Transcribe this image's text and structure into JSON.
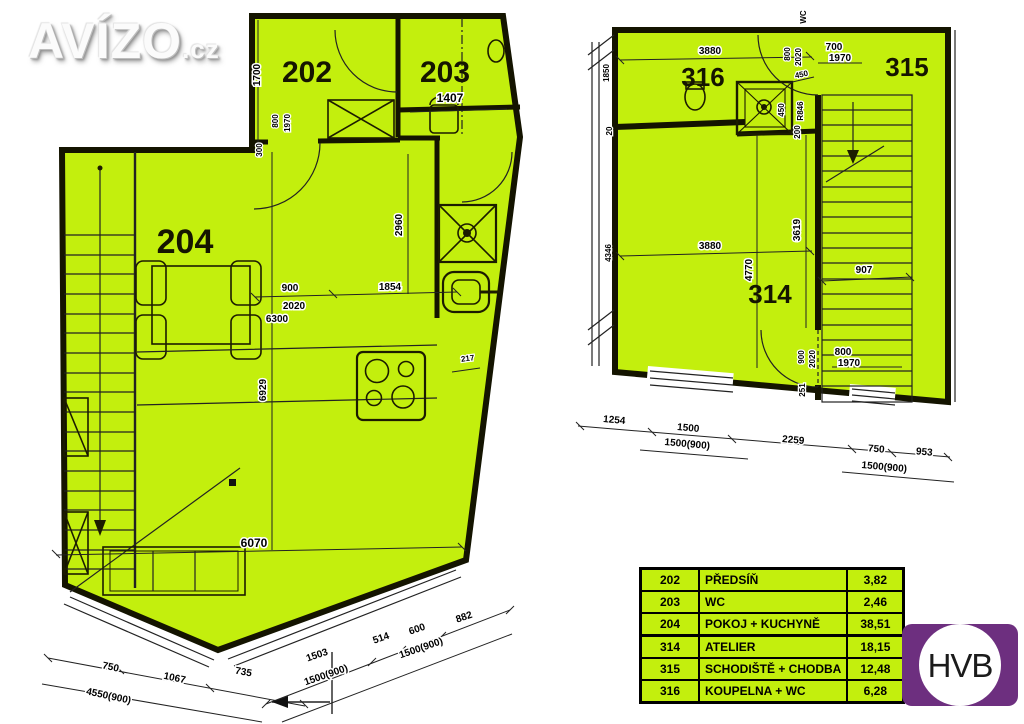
{
  "branding": {
    "logo_text": "AVÍZO",
    "logo_tld": ".cz"
  },
  "hvb": {
    "label": "HVB",
    "purple": "#6d2f7f"
  },
  "colors": {
    "plan_green": "#c3ef0d",
    "wall_black": "#141400"
  },
  "left_plan": {
    "room_labels": {
      "r202": "202",
      "r203": "203",
      "r204": "204"
    },
    "dims": {
      "w1700": "1700",
      "w800": "800",
      "w1970": "1970",
      "w300": "300",
      "w1407": "1407",
      "w2960": "2960",
      "w900": "900",
      "w2020": "2020",
      "w6300": "6300",
      "w1854": "1854",
      "w217": "217",
      "w6929": "6929",
      "w6070": "6070",
      "w750": "750",
      "w1067": "1067",
      "w735": "735",
      "w4550_900": "4550(900)",
      "w1503": "1503",
      "w1500_900a": "1500(900)",
      "w514": "514",
      "w600": "600",
      "w1500_900b": "1500(900)",
      "w882": "882"
    }
  },
  "right_plan": {
    "room_labels": {
      "r314": "314",
      "r315": "315",
      "r316": "316"
    },
    "dims": {
      "w3880_top": "3880",
      "w1850": "1850",
      "wWC": "WC",
      "w800": "800",
      "w2020": "2020",
      "w700": "700",
      "w1970": "1970",
      "w450a": "450",
      "w450b": "450",
      "wR846": "R846",
      "w200": "200",
      "w20": "20",
      "w3880_mid": "3880",
      "w4346": "4346",
      "w4770": "4770",
      "w3619": "3619",
      "w907": "907",
      "w900b": "900",
      "w2020b": "2020",
      "w800b": "800",
      "w1970b": "1970",
      "w251": "251",
      "w1254": "1254",
      "w1500": "1500",
      "w1500_900a": "1500(900)",
      "w2259": "2259",
      "w750": "750",
      "w1500_900b": "1500(900)",
      "w953": "953"
    }
  },
  "legend": {
    "rows": [
      {
        "num": "202",
        "name": "PŘEDSÍŇ",
        "area": "3,82"
      },
      {
        "num": "203",
        "name": "WC",
        "area": "2,46"
      },
      {
        "num": "204",
        "name": "POKOJ + KUCHYNĚ",
        "area": "38,51"
      },
      {
        "num": "314",
        "name": "ATELIER",
        "area": "18,15"
      },
      {
        "num": "315",
        "name": "SCHODIŠTĚ + CHODBA",
        "area": "12,48"
      },
      {
        "num": "316",
        "name": "KOUPELNA + WC",
        "area": "6,28"
      }
    ]
  }
}
